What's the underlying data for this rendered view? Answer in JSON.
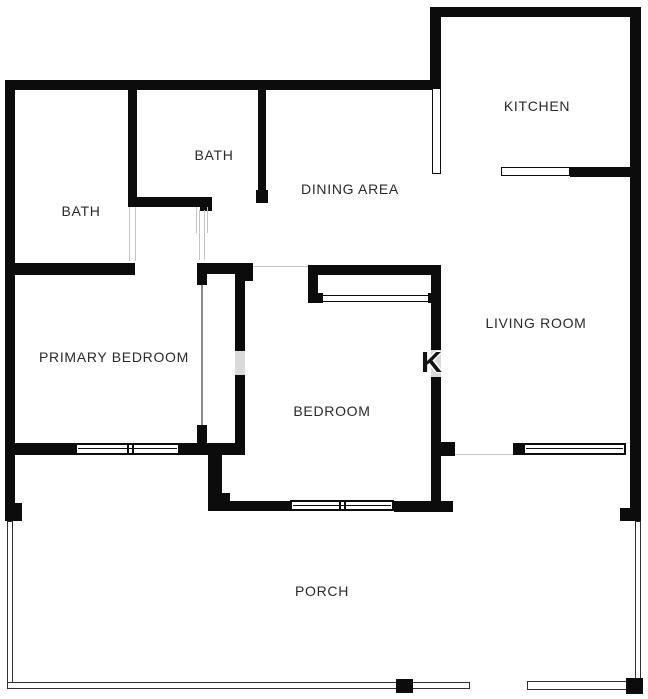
{
  "colors": {
    "wall": "#0c0c0c",
    "background": "#ffffff",
    "label_text": "#2a2a2a",
    "opening_line": "#c4c4c4",
    "railing_line": "#303030"
  },
  "rooms": [
    {
      "id": "kitchen",
      "label": "KITCHEN"
    },
    {
      "id": "bath-upper",
      "label": "BATH"
    },
    {
      "id": "bath-lower",
      "label": "BATH"
    },
    {
      "id": "dining-area",
      "label": "DINING AREA"
    },
    {
      "id": "living-room",
      "label": "LIVING ROOM"
    },
    {
      "id": "primary-bedroom",
      "label": "PRIMARY BEDROOM"
    },
    {
      "id": "bedroom",
      "label": "BEDROOM"
    },
    {
      "id": "porch",
      "label": "PORCH"
    }
  ],
  "watermark": {
    "glyph": "K"
  }
}
